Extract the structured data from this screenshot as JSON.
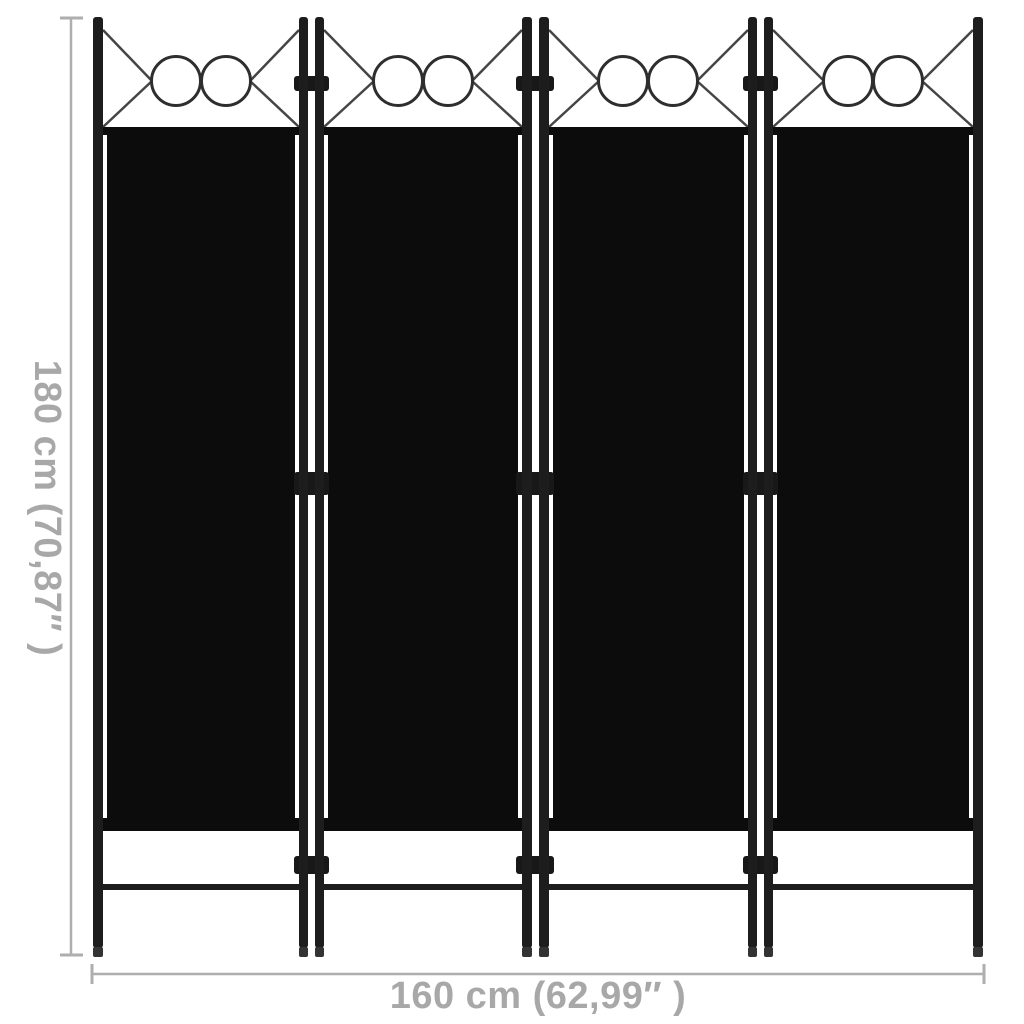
{
  "divider": {
    "panel_count": 4,
    "rings_per_panel": 2,
    "hinge_count": 3
  },
  "dimensions": {
    "height_label": "180 cm (70,87″ )",
    "width_label": "160 cm (62,99″ )"
  },
  "colors": {
    "background": "#ffffff",
    "frame": "#1d1d1d",
    "fabric": "#0c0c0c",
    "hinge": "#181818",
    "foot": "#333333",
    "decor": "#454545",
    "ring": "#2e2e2e",
    "dim_line": "#aeaeae",
    "dim_text": "#a8a8a8"
  }
}
